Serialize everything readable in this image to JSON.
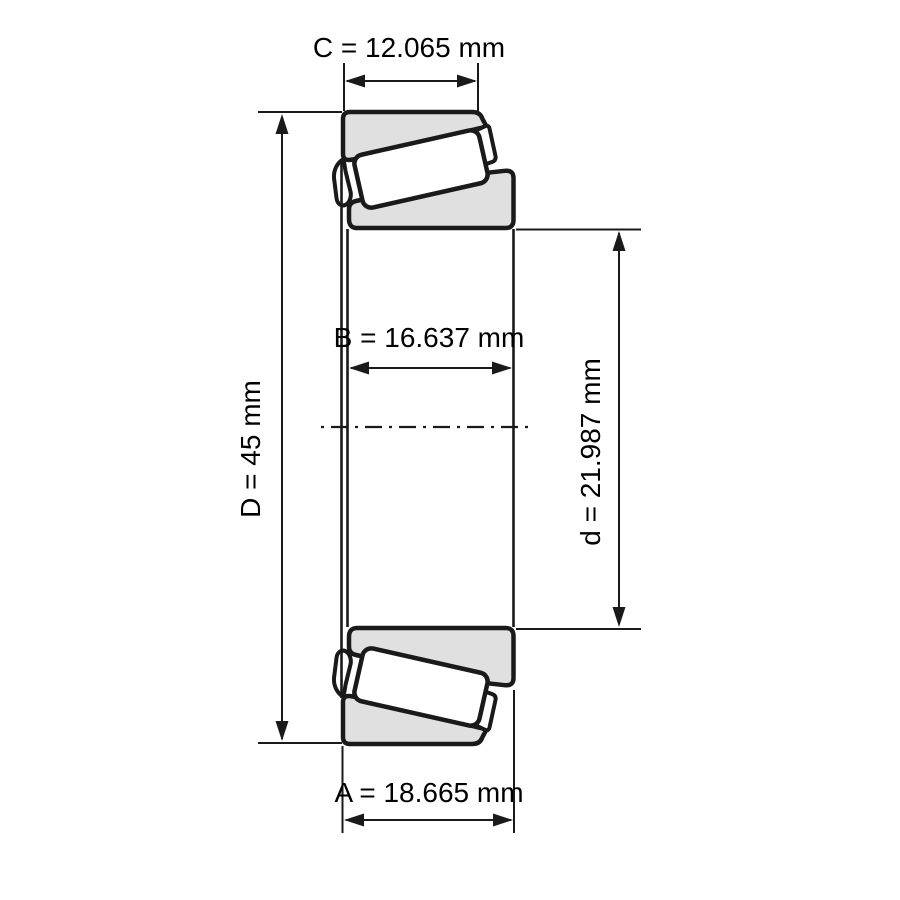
{
  "drawing": {
    "description": "Tapered roller bearing cross-section dimension drawing",
    "dimensions": {
      "C": {
        "symbol": "C",
        "value": "12.065",
        "unit": "mm",
        "label": "C = 12.065 mm"
      },
      "D": {
        "symbol": "D",
        "value": "45",
        "unit": "mm",
        "label": "D = 45 mm"
      },
      "B": {
        "symbol": "B",
        "value": "16.637",
        "unit": "mm",
        "label": "B = 16.637 mm"
      },
      "d": {
        "symbol": "d",
        "value": "21.987",
        "unit": "mm",
        "label": "d = 21.987 mm"
      },
      "A": {
        "symbol": "A",
        "value": "18.665",
        "unit": "mm",
        "label": "A = 18.665 mm"
      }
    },
    "colors": {
      "outline": "#1a1a1a",
      "ring_fill": "#e0e0e0",
      "roller_fill": "#ffffff",
      "background": "#ffffff",
      "text": "#000000"
    }
  }
}
